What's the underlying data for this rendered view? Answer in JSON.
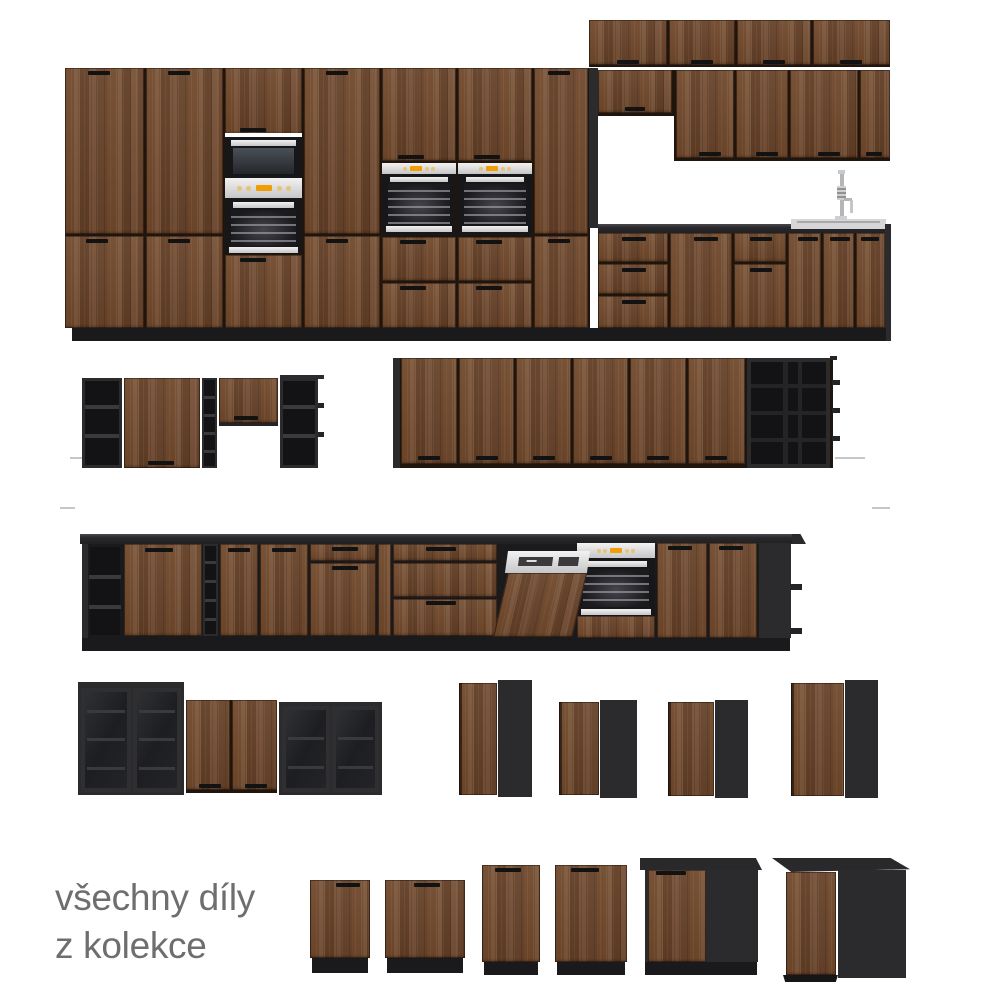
{
  "caption": {
    "line1": "všechny díly",
    "line2": "z kolekce"
  },
  "colors": {
    "background": "#ffffff",
    "caption_text": "#6e6e6e",
    "cabinet_wood": "#6d4930",
    "cabinet_black": "#2b2b2d",
    "plinth_black": "#1a1a1c",
    "countertop_black": "#232325",
    "appliance_steel": "#d9d9db",
    "appliance_display_orange": "#f19d06",
    "sink_steel": "#d6d6d8"
  }
}
